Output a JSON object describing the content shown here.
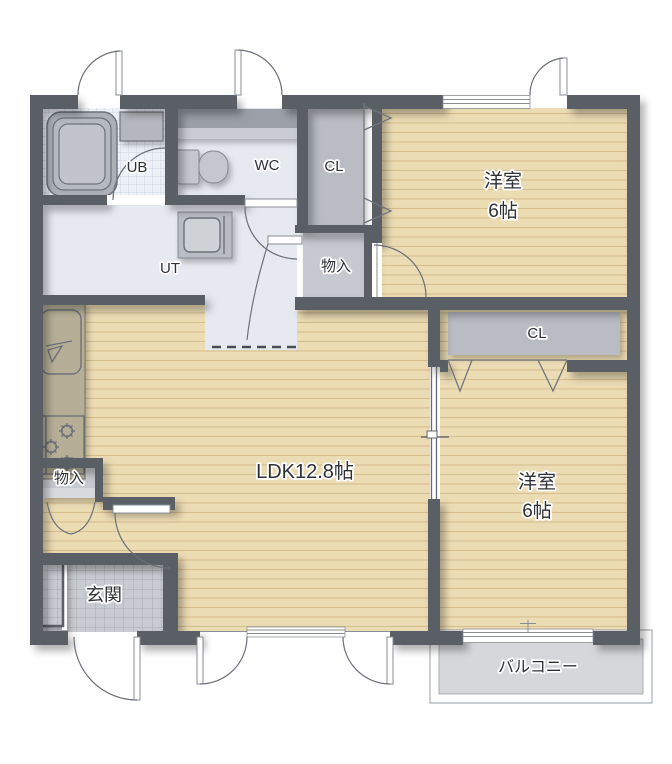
{
  "plan": {
    "type": "floorplan",
    "rooms": {
      "ub": {
        "label": "UB"
      },
      "wc": {
        "label": "WC"
      },
      "ut": {
        "label": "UT"
      },
      "closet_top": {
        "label": "CL"
      },
      "storage_upper": {
        "label": "物入"
      },
      "bedroom_top": {
        "name": "洋室",
        "size": "6帖"
      },
      "ldk": {
        "label": "LDK12.8帖"
      },
      "closet_right": {
        "label": "CL"
      },
      "bedroom_bottom": {
        "name": "洋室",
        "size": "6帖"
      },
      "storage_lower": {
        "label": "物入"
      },
      "entrance": {
        "label": "玄関"
      },
      "balcony": {
        "label": "バルコニー"
      }
    },
    "colors": {
      "wall": "#5a5f66",
      "wood": "#ecdcb4",
      "wood-line": "#d0b787",
      "ut": "#e7e9f1",
      "ubtile": "#eef1f7",
      "closet": "#b9bdc3",
      "storage": "#c6c9cf",
      "gtile": "#c8cbd1",
      "balcony": "#d5d7db",
      "counter": "#b6ae97",
      "ink": "#2e3135"
    }
  }
}
